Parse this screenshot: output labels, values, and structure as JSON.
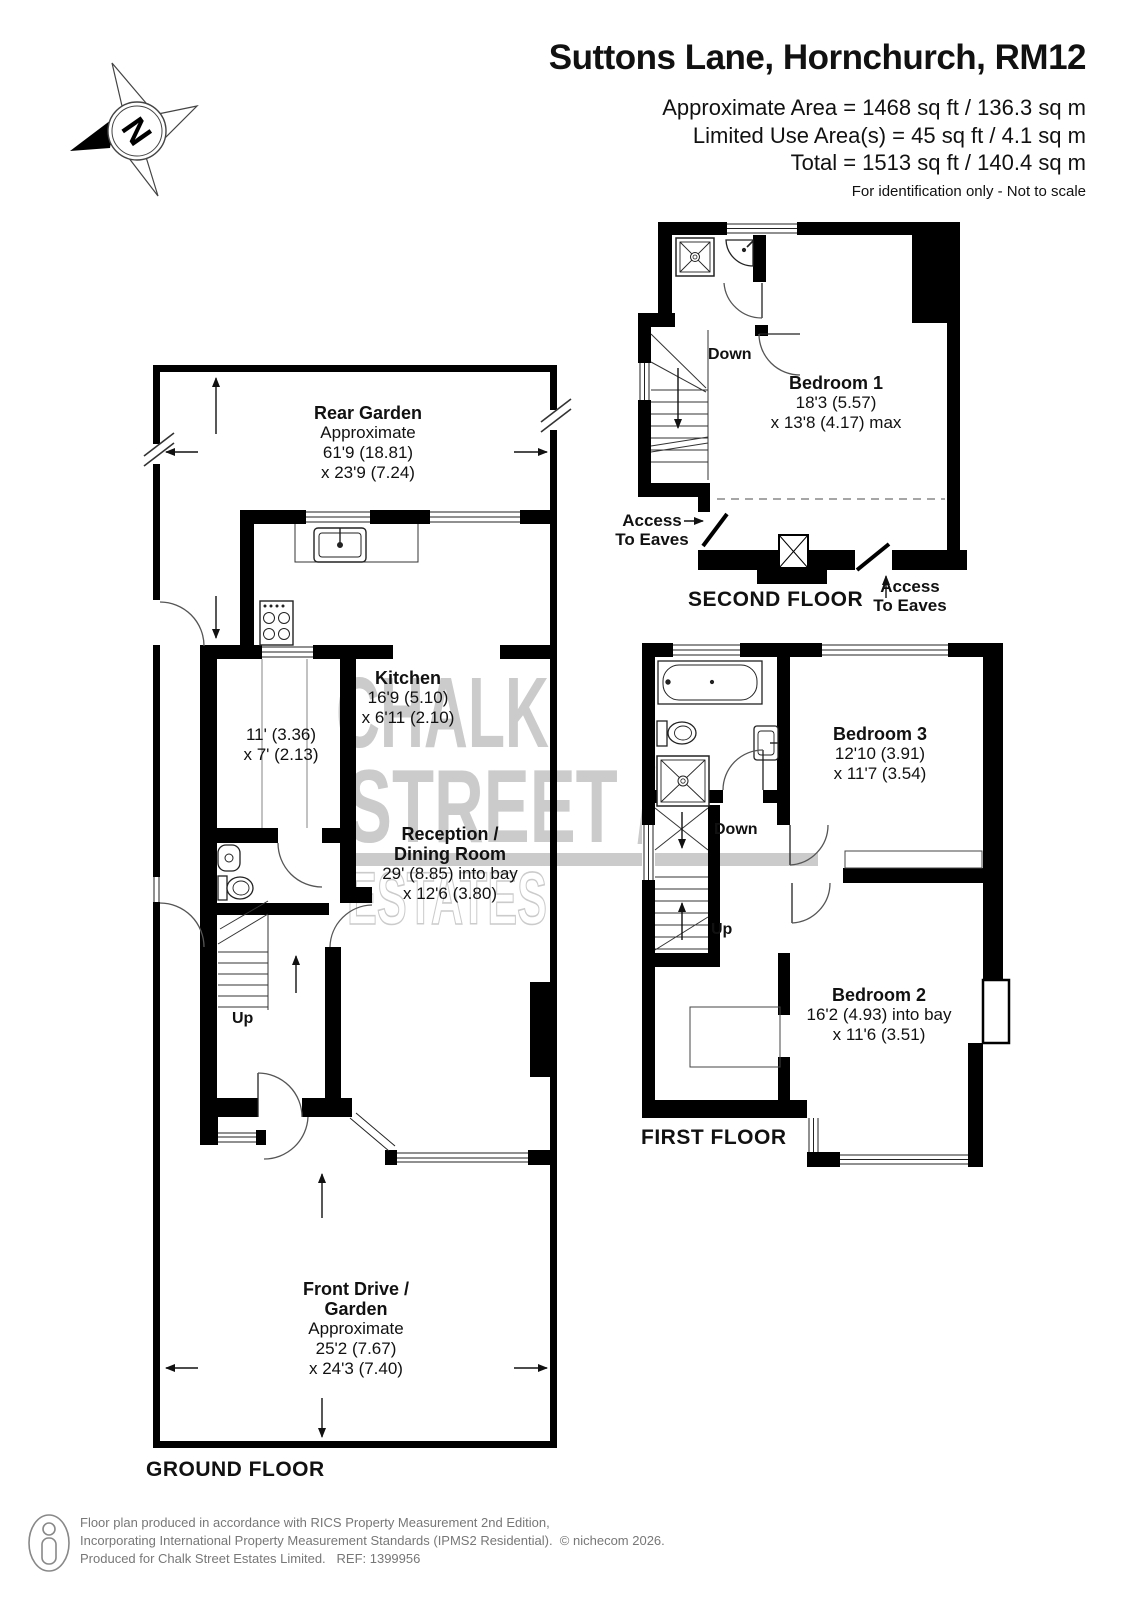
{
  "header": {
    "title": "Suttons Lane, Hornchurch, RM12",
    "area_lines": [
      "Approximate Area = 1468 sq ft / 136.3 sq m",
      "Limited Use Area(s) = 45 sq ft / 4.1 sq m",
      "Total = 1513 sq ft / 140.4 sq m"
    ],
    "disclaimer": "For identification only - Not to scale"
  },
  "compass": {
    "north_label": "N"
  },
  "watermark": {
    "line1": "CHALK",
    "line2": "STREET /",
    "line3": "ESTATES"
  },
  "floors": {
    "ground": {
      "title": "GROUND FLOOR",
      "stairs_up": "Up",
      "rooms": {
        "rear_garden": {
          "name": "Rear Garden",
          "lines": [
            "Approximate",
            "61'9 (18.81)",
            "x 23'9 (7.24)"
          ]
        },
        "kitchen": {
          "name": "Kitchen",
          "lines": [
            "16'9 (5.10)",
            "x 6'11 (2.10)"
          ]
        },
        "store": {
          "lines": [
            "11' (3.36)",
            "x 7' (2.13)"
          ]
        },
        "reception": {
          "name_line1": "Reception /",
          "name_line2": "Dining Room",
          "lines": [
            "29' (8.85) into bay",
            "x 12'6 (3.80)"
          ]
        },
        "front_drive": {
          "name_line1": "Front Drive /",
          "name_line2": "Garden",
          "lines": [
            "Approximate",
            "25'2 (7.67)",
            "x 24'3 (7.40)"
          ]
        }
      }
    },
    "first": {
      "title": "FIRST FLOOR",
      "stairs_down": "Down",
      "stairs_up": "Up",
      "rooms": {
        "bedroom3": {
          "name": "Bedroom 3",
          "lines": [
            "12'10 (3.91)",
            "x 11'7 (3.54)"
          ]
        },
        "bedroom2": {
          "name": "Bedroom 2",
          "lines": [
            "16'2 (4.93) into bay",
            "x 11'6 (3.51)"
          ]
        }
      }
    },
    "second": {
      "title": "SECOND FLOOR",
      "stairs_down": "Down",
      "eaves_left": {
        "line1": "Access",
        "line2": "To Eaves"
      },
      "eaves_right": {
        "line1": "Access",
        "line2": "To Eaves"
      },
      "rooms": {
        "bedroom1": {
          "name": "Bedroom 1",
          "lines": [
            "18'3 (5.57)",
            "x 13'8 (4.17) max"
          ]
        }
      }
    }
  },
  "footer": {
    "lines": [
      "Floor plan produced in accordance with RICS Property Measurement 2nd Edition,",
      "Incorporating International Property Measurement Standards (IPMS2 Residential).  © nichecom 2026.",
      "Produced for Chalk Street Estates Limited.   REF: 1399956"
    ]
  },
  "colors": {
    "wall": "#000000",
    "watermark": "#cbcbcb",
    "footer_text": "#777777"
  }
}
